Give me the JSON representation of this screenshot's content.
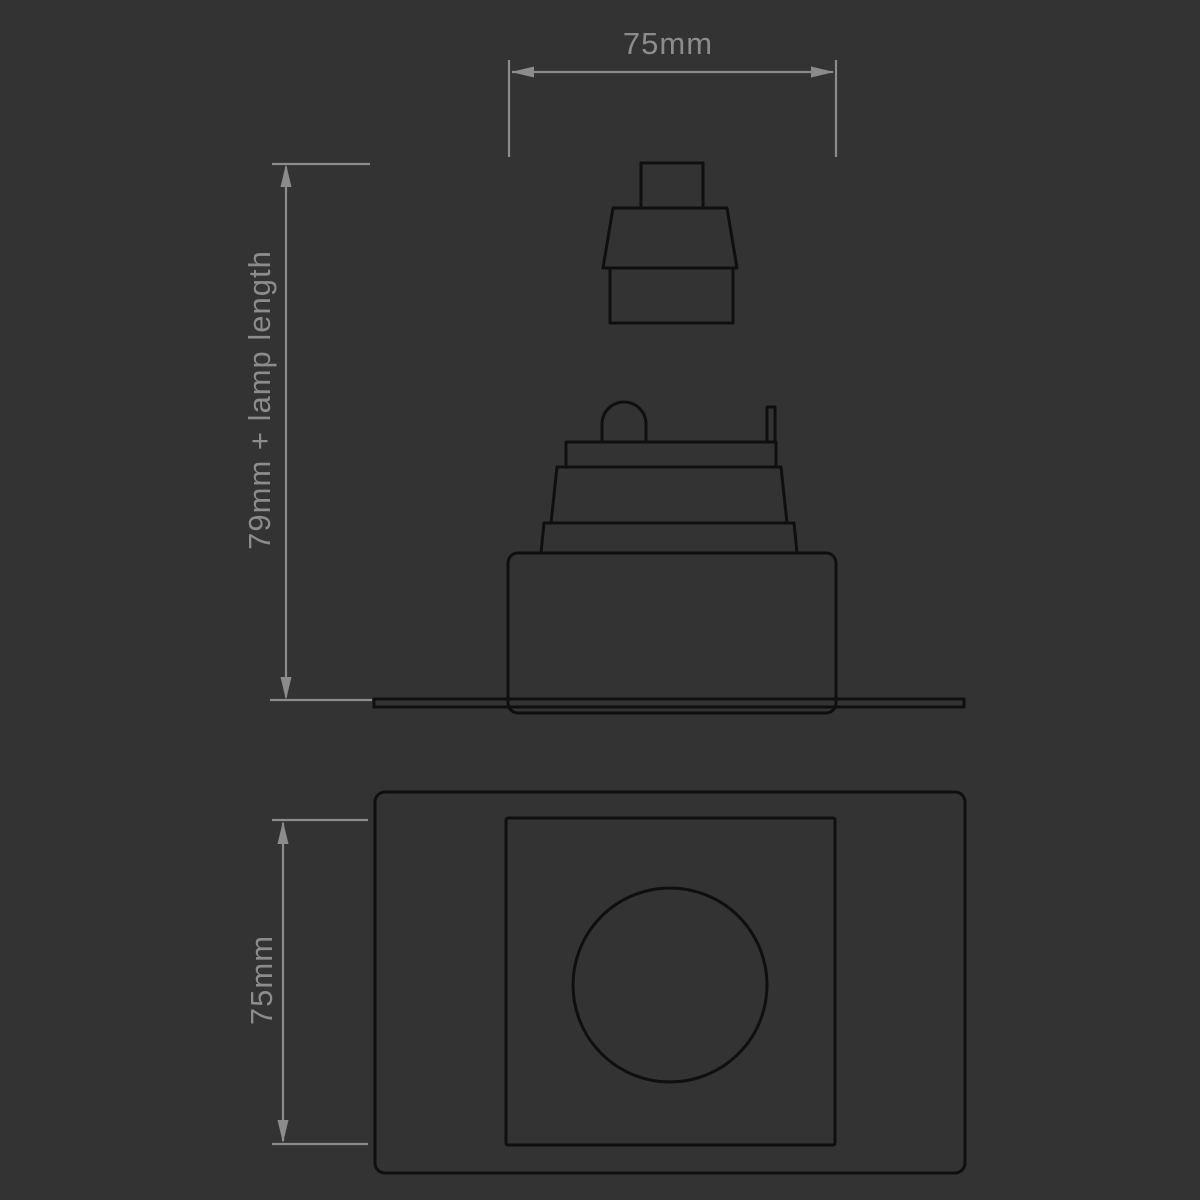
{
  "labels": {
    "top_width": "75mm",
    "overall_height": "79mm + lamp length",
    "plan_height": "75mm"
  },
  "colors": {
    "background": "#333333",
    "dimension_lines": "#8c8c8c",
    "drawing_lines": "#0f0f0f"
  }
}
